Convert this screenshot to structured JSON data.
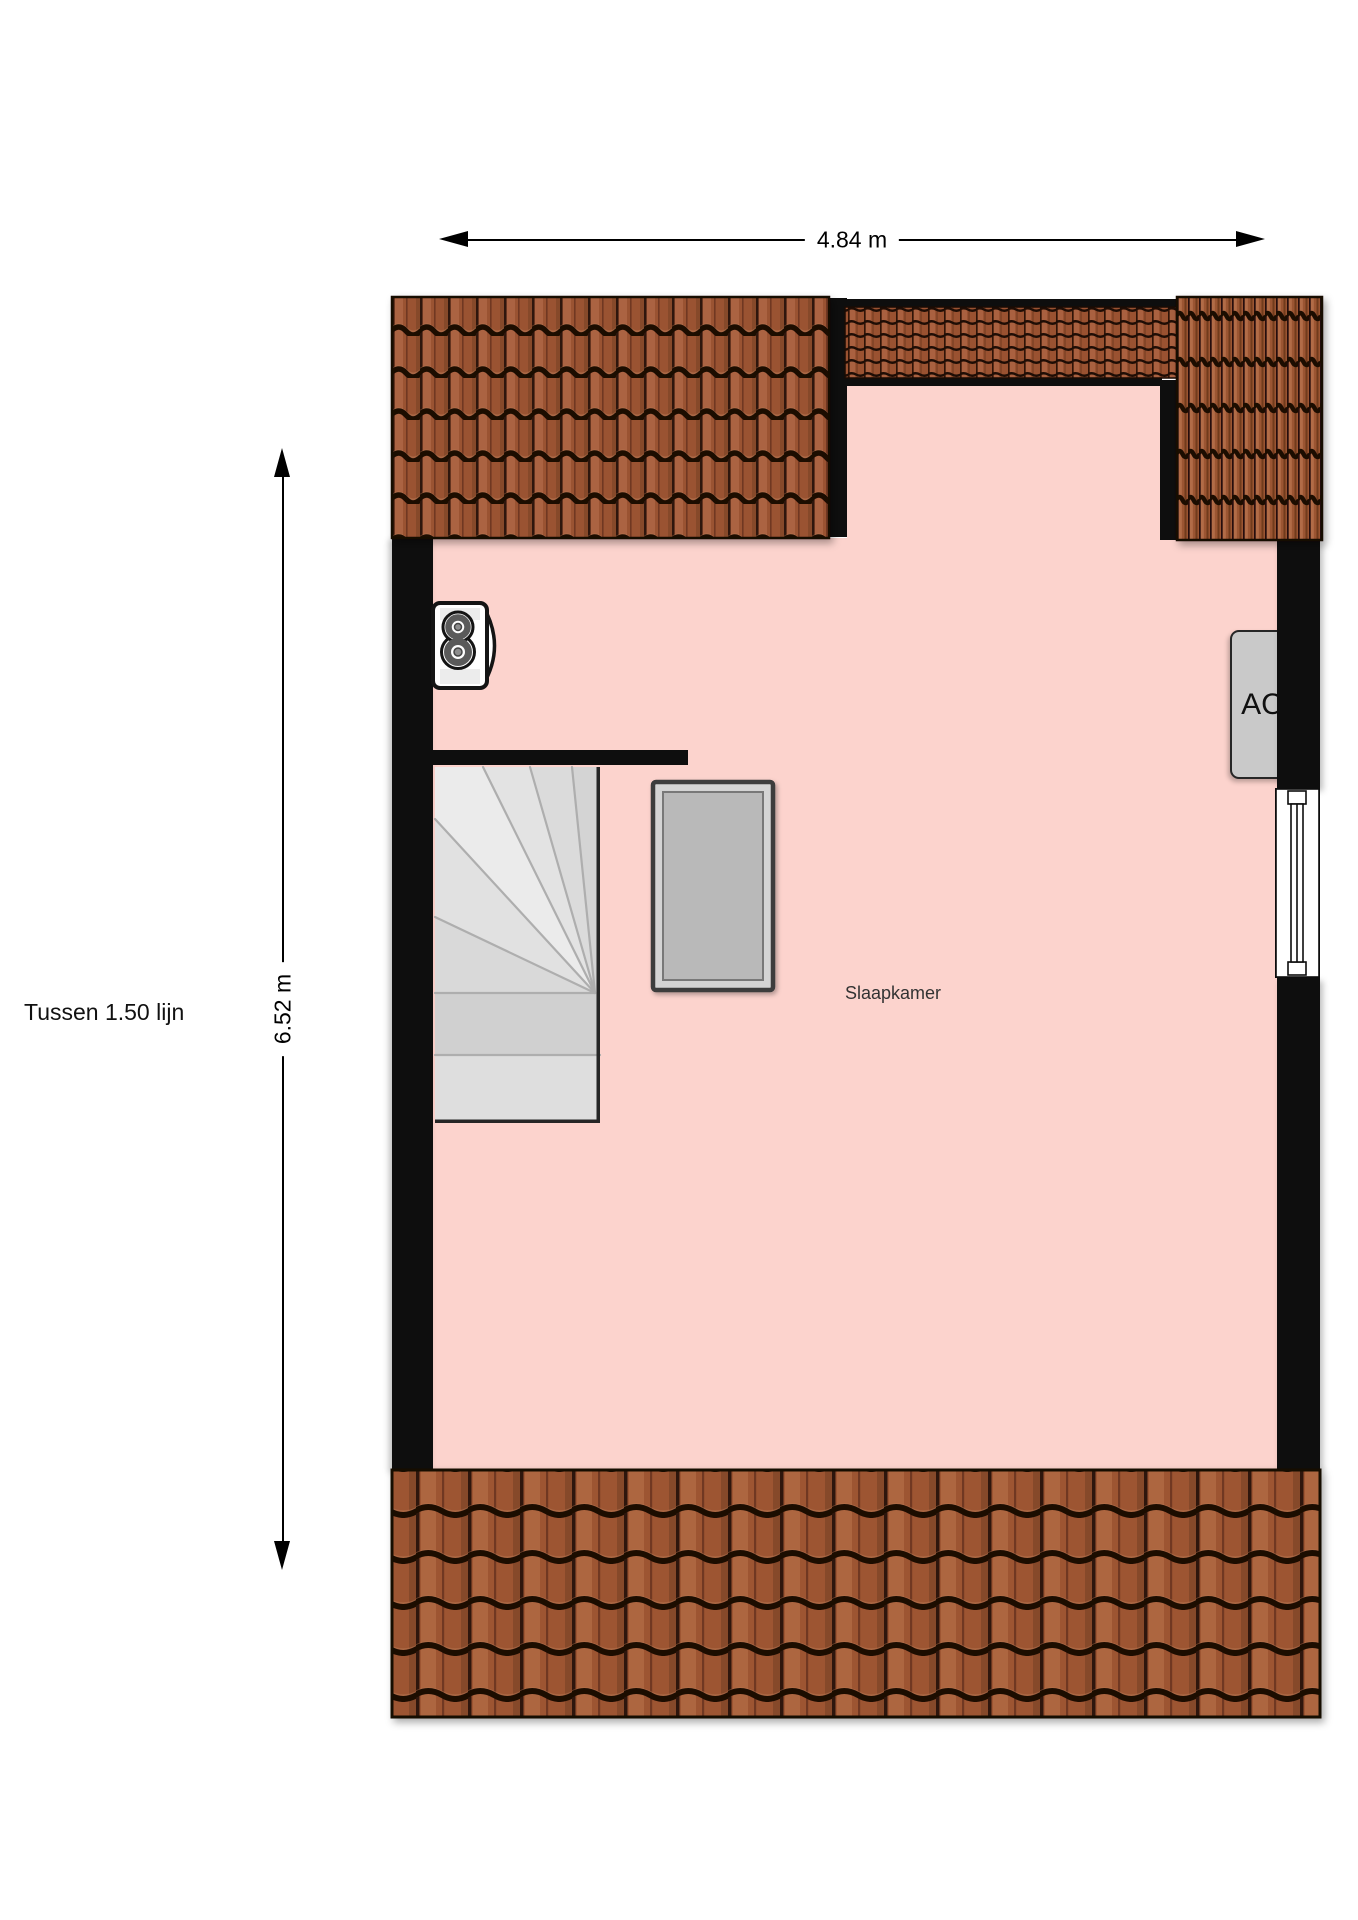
{
  "plan": {
    "room_label": "Slaapkamer",
    "zone_label": "Tussen 1.50 lijn",
    "ac_label": "AC",
    "width_dimension": "4.84 m",
    "height_dimension": "6.52 m"
  },
  "colors": {
    "background": "#ffffff",
    "room_fill": "#fcd3cd",
    "wall": "#0e0e0e",
    "roof_tile_base": "#9a5231",
    "roof_tile_grout": "#1f0d05",
    "stairs_fill": "#dedede",
    "roof_window_fill": "#b9b9b9",
    "ac_fill": "#c9c9c9",
    "window_frame": "#ffffff",
    "dimension_line": "#000000"
  }
}
